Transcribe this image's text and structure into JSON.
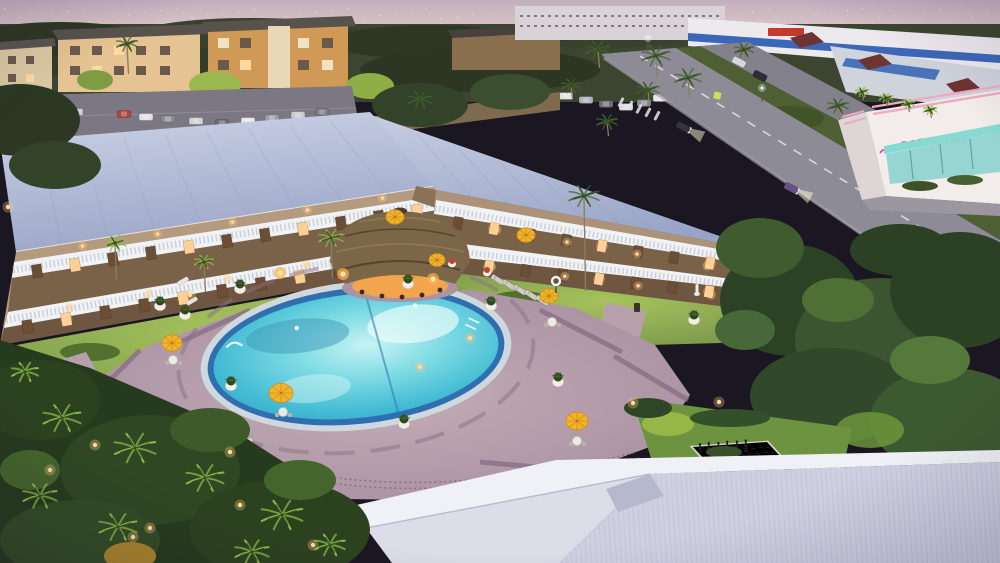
{
  "meta": {
    "alt": "Aerial dusk view of a two-story resort hotel with two wings, white balustrade balconies, a glowing oval swimming pool on a mauve paver deck, a thatched tiki bar hut, yellow patio umbrellas, white planters, lounge chairs, a giant outdoor chessboard on a lawn, white foreground roofs, tropical landscaping with lit palm trees, and a street with a pink neon car wash building at twilight."
  },
  "signs": {
    "car_wash_text": "CAR WASH"
  },
  "palette": {
    "accent_pink": "#ff2f9e",
    "awning_teal": "#85dbd2",
    "stripe_blue": "#3c67b6",
    "umbrella": "#f2b32c",
    "umbrella_rib": "#cf9118",
    "pool_rim": "#2f6fb0",
    "pool_water": "#55c8dc",
    "pool_glow": "#eafcfa",
    "deck": "#b49cab",
    "deck_band": "#8a7086",
    "roof": "#aeb9d6",
    "facade": "#b49a7e",
    "balustrade": "#f0f2f5",
    "door_dark": "#6b4e35",
    "window_lit": "#ffd096",
    "lawn": "#87a751",
    "lawn_lit": "#b9d45e",
    "hedge": "#2f4526",
    "thatch": "#7c6648",
    "thatch_glow": "#ffa83e",
    "planter_pot": "#f3efe7",
    "plant": "#2f481f",
    "lounger": "#d2ccc6",
    "road": "#8d8c96",
    "fg_roof": "#dcdde8",
    "chess_light": "#e9e5d8",
    "chess_dark": "#28282a",
    "warm_light": "#ffd9a2",
    "sky_top": "#c3aebe",
    "sky_horizon": "#f6ead9"
  },
  "pool": {
    "cx": 356,
    "cy": 356,
    "rx": 143,
    "ry": 62,
    "rotation": -6
  },
  "umbrellas": [
    {
      "x": 395,
      "y": 217,
      "r": 9
    },
    {
      "x": 437,
      "y": 260,
      "r": 8
    },
    {
      "x": 526,
      "y": 235,
      "r": 9
    },
    {
      "x": 549,
      "y": 296,
      "r": 9
    },
    {
      "x": 577,
      "y": 421,
      "r": 11
    },
    {
      "x": 281,
      "y": 393,
      "r": 12
    },
    {
      "x": 172,
      "y": 343,
      "r": 10
    }
  ],
  "tables": [
    [
      283,
      412
    ],
    [
      577,
      441
    ],
    [
      173,
      360
    ],
    [
      552,
      322
    ]
  ],
  "planters": [
    [
      240,
      289
    ],
    [
      408,
      284
    ],
    [
      491,
      306
    ],
    [
      231,
      386
    ],
    [
      404,
      424
    ],
    [
      558,
      382
    ],
    [
      160,
      306
    ],
    [
      185,
      315
    ],
    [
      694,
      320
    ]
  ],
  "flower_pots": [
    [
      452,
      264
    ],
    [
      487,
      273
    ]
  ],
  "life_ring": [
    556,
    281
  ],
  "statue": [
    697,
    290
  ],
  "trash_bin": [
    637,
    308
  ],
  "pool_sign": [
    97,
    423
  ],
  "table_glows": [
    [
      280,
      273
    ],
    [
      343,
      274
    ],
    [
      433,
      279
    ]
  ],
  "lounger_rows": [
    {
      "x1": 100,
      "y1": 497,
      "x2": 256,
      "y2": 438,
      "count": 8,
      "angle": -23
    },
    {
      "x1": 492,
      "y1": 277,
      "x2": 548,
      "y2": 303,
      "count": 5,
      "angle": 32
    }
  ],
  "lounger_singles": [
    [
      183,
      281
    ],
    [
      192,
      301
    ]
  ],
  "parking_cars": [
    [
      14,
      103,
      "#dcdcde"
    ],
    [
      34,
      107,
      "#9b9ba1"
    ],
    [
      54,
      111,
      "#6e6e78"
    ],
    [
      76,
      112,
      "#cfcfd3"
    ],
    [
      124,
      114,
      "#b24339"
    ],
    [
      146,
      117,
      "#e2e2e4"
    ],
    [
      168,
      119,
      "#8c8c94"
    ],
    [
      196,
      121,
      "#d2d2d6"
    ],
    [
      222,
      123,
      "#6b6b75"
    ],
    [
      248,
      121,
      "#e6e6e8"
    ],
    [
      272,
      118,
      "#9aa0a8"
    ],
    [
      298,
      115,
      "#cacace"
    ],
    [
      322,
      112,
      "#7a7a84"
    ],
    [
      566,
      96,
      "#e2e2e6"
    ],
    [
      586,
      100,
      "#b2b2b8"
    ],
    [
      606,
      104,
      "#6e6e78"
    ],
    [
      626,
      107,
      "#dadade"
    ],
    [
      644,
      103,
      "#8c8c92"
    ],
    [
      660,
      98,
      "#e8e8ea"
    ]
  ],
  "road_cars": [
    {
      "x": 683,
      "y": 127,
      "a": 27,
      "c": "#34343c",
      "lights": true
    },
    {
      "x": 791,
      "y": 188,
      "a": 27,
      "c": "#6a4e86",
      "lights": true
    },
    {
      "x": 739,
      "y": 62,
      "a": 27,
      "c": "#d8d8dc",
      "lights": false
    },
    {
      "x": 760,
      "y": 76,
      "a": 27,
      "c": "#2e2e36",
      "lights": false
    }
  ],
  "palms": [
    {
      "x": 598,
      "y": 50,
      "s": 13,
      "lit": false,
      "t": 18
    },
    {
      "x": 656,
      "y": 56,
      "s": 15,
      "lit": false,
      "t": 22
    },
    {
      "x": 688,
      "y": 78,
      "s": 14,
      "lit": false,
      "t": 20
    },
    {
      "x": 648,
      "y": 90,
      "s": 12,
      "lit": false,
      "t": 16
    },
    {
      "x": 607,
      "y": 122,
      "s": 11,
      "lit": false,
      "t": 14
    },
    {
      "x": 571,
      "y": 86,
      "s": 10,
      "lit": false,
      "t": 12
    },
    {
      "x": 744,
      "y": 50,
      "s": 10,
      "lit": false,
      "t": 12
    },
    {
      "x": 838,
      "y": 106,
      "s": 11,
      "lit": false,
      "t": 14
    },
    {
      "x": 862,
      "y": 92,
      "s": 7,
      "lit": true,
      "t": 8
    },
    {
      "x": 886,
      "y": 98,
      "s": 7,
      "lit": true,
      "t": 8
    },
    {
      "x": 908,
      "y": 104,
      "s": 7,
      "lit": true,
      "t": 8
    },
    {
      "x": 930,
      "y": 110,
      "s": 7,
      "lit": true,
      "t": 8
    },
    {
      "x": 584,
      "y": 196,
      "s": 16,
      "lit": false,
      "t": 95
    },
    {
      "x": 331,
      "y": 238,
      "s": 13,
      "lit": true,
      "t": 40
    },
    {
      "x": 115,
      "y": 243,
      "s": 12,
      "lit": true,
      "t": 38
    },
    {
      "x": 204,
      "y": 262,
      "s": 10,
      "lit": true,
      "t": 30
    },
    {
      "x": 127,
      "y": 44,
      "s": 11,
      "lit": false,
      "t": 30
    },
    {
      "x": 420,
      "y": 100,
      "s": 12,
      "lit": false,
      "t": 0
    }
  ],
  "garden_palms": [
    {
      "x": 62,
      "y": 418,
      "s": 20
    },
    {
      "x": 135,
      "y": 448,
      "s": 22
    },
    {
      "x": 205,
      "y": 478,
      "s": 20
    },
    {
      "x": 282,
      "y": 515,
      "s": 22
    },
    {
      "x": 40,
      "y": 496,
      "s": 18
    },
    {
      "x": 118,
      "y": 527,
      "s": 20
    },
    {
      "x": 252,
      "y": 552,
      "s": 18
    },
    {
      "x": 330,
      "y": 545,
      "s": 16
    },
    {
      "x": 25,
      "y": 372,
      "s": 14
    }
  ],
  "deck_lights": [
    [
      633,
      403
    ],
    [
      719,
      402
    ],
    [
      190,
      295
    ],
    [
      420,
      367
    ],
    [
      230,
      452
    ],
    [
      8,
      207
    ],
    [
      470,
      338
    ]
  ],
  "garden_lights": [
    [
      50,
      470
    ],
    [
      150,
      528
    ],
    [
      95,
      445
    ],
    [
      240,
      505
    ],
    [
      133,
      537
    ],
    [
      313,
      545
    ]
  ],
  "street_lights": [
    [
      648,
      38
    ],
    [
      762,
      88
    ],
    [
      872,
      158
    ]
  ],
  "sconce_rows": [
    {
      "x1": 45,
      "y1": 252,
      "x2": 420,
      "y2": 192,
      "n": 5
    },
    {
      "x1": 30,
      "y1": 315,
      "x2": 425,
      "y2": 243,
      "n": 5
    },
    {
      "x1": 462,
      "y1": 224,
      "x2": 742,
      "y2": 272,
      "n": 4
    },
    {
      "x1": 455,
      "y1": 262,
      "x2": 748,
      "y2": 300,
      "n": 4
    }
  ],
  "door_rows": [
    {
      "x1": 18,
      "y1": 274,
      "x2": 436,
      "y2": 208,
      "n": 11,
      "ang": -9,
      "w": 10,
      "h": 13
    },
    {
      "x1": 8,
      "y1": 330,
      "x2": 436,
      "y2": 252,
      "n": 11,
      "ang": -9,
      "w": 10,
      "h": 13
    },
    {
      "x1": 440,
      "y1": 220,
      "x2": 764,
      "y2": 272,
      "n": 9,
      "ang": 10,
      "w": 9,
      "h": 12
    },
    {
      "x1": 434,
      "y1": 260,
      "x2": 764,
      "y2": 298,
      "n": 9,
      "ang": 10,
      "w": 9,
      "h": 12
    }
  ],
  "roof_seams": [
    {
      "a": [
        0,
        148
      ],
      "b": [
        372,
        118
      ],
      "a2": [
        14,
        250
      ],
      "b2": [
        436,
        188
      ],
      "n": 9
    },
    {
      "a": [
        376,
        120
      ],
      "b": [
        746,
        246
      ],
      "a2": [
        436,
        192
      ],
      "b2": [
        768,
        252
      ],
      "n": 9
    }
  ],
  "chess": {
    "origin": [
      693,
      447
    ],
    "col": [
      9.25,
      -0.625
    ],
    "row": [
      4.625,
      5
    ],
    "black_pieces": [
      [
        0.5,
        0.5
      ],
      [
        1.5,
        0.4
      ],
      [
        2.5,
        0.5
      ],
      [
        3.5,
        0.4
      ],
      [
        4.5,
        0.5
      ],
      [
        5.5,
        0.4
      ],
      [
        1.0,
        1.4
      ],
      [
        2.2,
        1.5
      ],
      [
        3.8,
        1.4
      ],
      [
        5.0,
        1.5
      ]
    ],
    "white_pieces": [
      [
        2.5,
        6.5
      ],
      [
        3.5,
        6.6
      ],
      [
        4.5,
        6.4
      ],
      [
        5.5,
        6.5
      ],
      [
        6.5,
        6.4
      ],
      [
        3.0,
        7.5
      ],
      [
        4.2,
        7.6
      ],
      [
        5.4,
        7.4
      ],
      [
        6.6,
        7.5
      ],
      [
        7.4,
        7.2
      ]
    ]
  },
  "city_lights": {
    "count": 64
  },
  "crosswalk": {
    "x": 622,
    "y": 97,
    "n": 5
  }
}
